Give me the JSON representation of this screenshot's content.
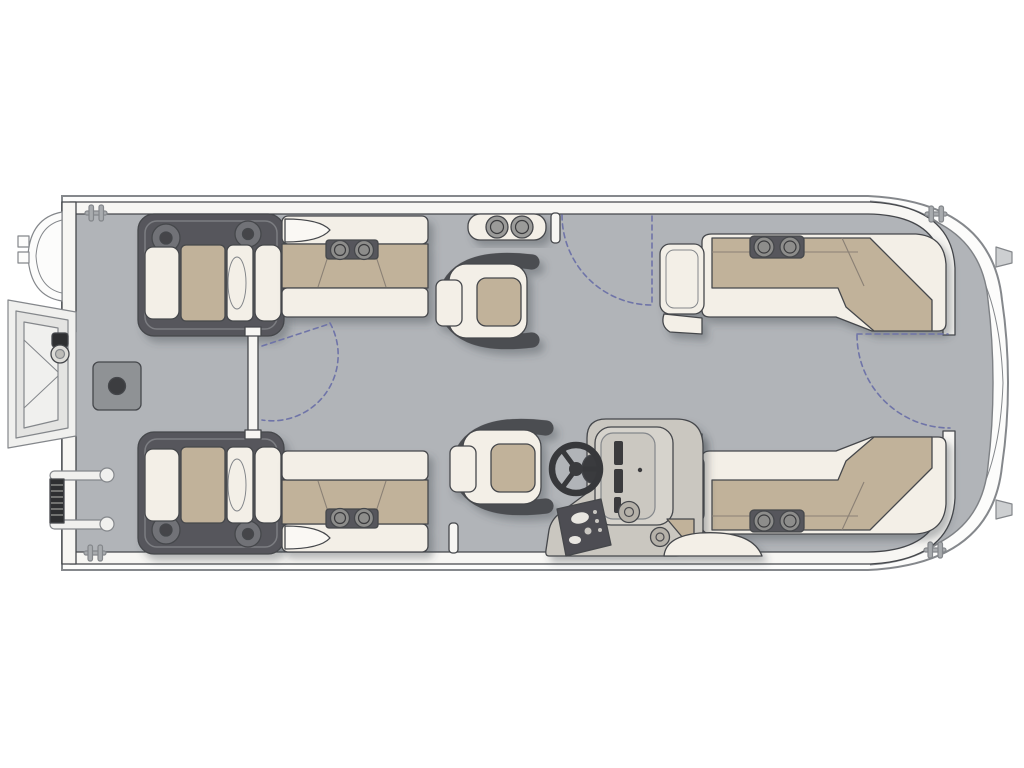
{
  "document": {
    "title": "Pontoon Boat Deck Floor Plan",
    "view": "Top-down deck layout, bow at left, stern at right",
    "visible_text": ""
  },
  "colors": {
    "deck": "#b1b4b8",
    "hull": "#fcfcfb",
    "fence": "#f7f6f3",
    "cream": "#f3efe7",
    "tan": "#c1b29a",
    "dark": "#56575b",
    "console": "#cac7c0",
    "arc": "#6f74a8",
    "cleat": "#a8abae",
    "mount": "#8f9295",
    "outline": "#45474b",
    "outlineSoft": "#84878b",
    "seam": "#8a8074"
  },
  "components": {
    "hull": "Pontoon hull and rub rail",
    "deck": "Gray vinyl deck floor",
    "fence": "Perimeter fence panels",
    "bow_nose": "Port bow nose cone",
    "bow_ladder": "Bow boarding gate with ladder, deployed outboard",
    "side_ladder": "Folded boarding ladder on port bow",
    "pedestal_mount": "Deck table pedestal mount",
    "bow_gate": "Closed bow walkway gate with swing arc",
    "port_chaise": "Port bow chaise lounge seat",
    "starboard_chaise": "Starboard bow chaise lounge seat",
    "port_bench": "Port bench seat with cup holders",
    "starboard_bench": "Starboard bench seat with cup holders",
    "bow_recliner_chair": "Forward swivel recliner chair",
    "helm_chair": "Helm captain's chair",
    "helm_console": "Helm console with steering wheel, gauges and switch panel",
    "cup_holder_console": "Rail-mounted twin cup holder console",
    "gate_post_port": "Port gate latch post",
    "gate_post_starboard": "Starboard gate latch post",
    "port_gate": "Port side gate shown open with swing arc",
    "stern_gate": "Stern walkway gate swing arc",
    "port_aft_couch": "Port aft L-shaped lounge with cup holders",
    "starboard_aft_couch": "Starboard aft L-shaped lounge with cup holders",
    "cleats": "Mooring cleats at bow and stern corners",
    "stern_platform": "Stern platform with transom brackets"
  }
}
